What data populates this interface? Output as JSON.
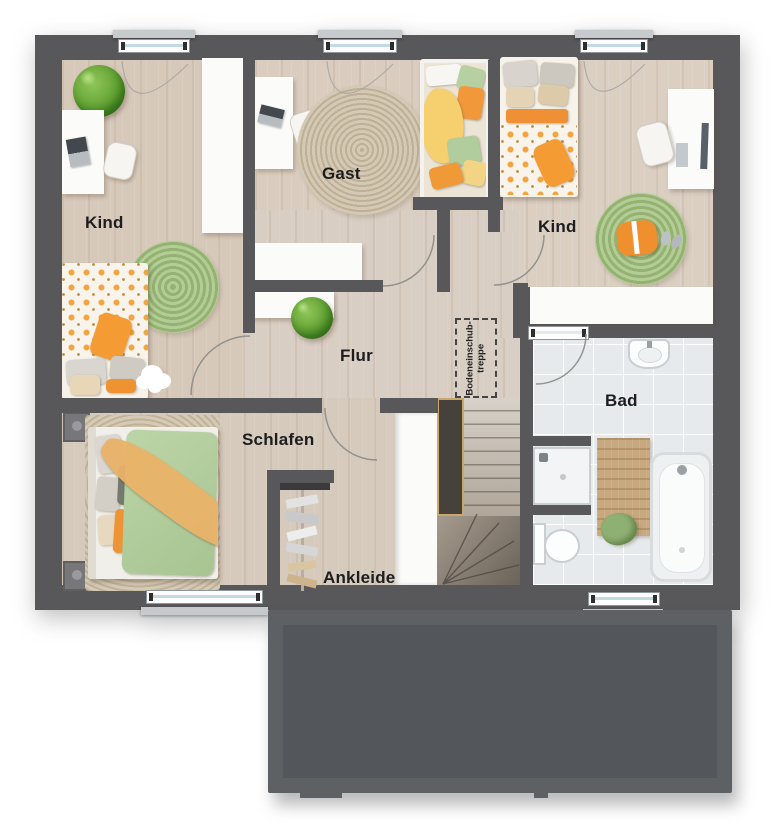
{
  "floorplan": {
    "rooms": [
      {
        "id": "kind-left",
        "label": "Kind"
      },
      {
        "id": "gast",
        "label": "Gast"
      },
      {
        "id": "kind-right",
        "label": "Kind"
      },
      {
        "id": "flur",
        "label": "Flur"
      },
      {
        "id": "schlafen",
        "label": "Schlafen"
      },
      {
        "id": "ankleide",
        "label": "Ankleide"
      },
      {
        "id": "bad",
        "label": "Bad"
      }
    ],
    "loft_ladder_label": {
      "line1": "Bodeneinschub-",
      "line2": "treppe"
    },
    "colors": {
      "wall": "#58585b",
      "wood_floor": "#d8ccbf",
      "bathroom_tile": "#e7eaec",
      "rug_green": "#a9c687",
      "rug_beige": "#ccbfa7",
      "bed_orange": "#f09a37",
      "bed_yellow": "#f5d06f",
      "bed_green": "#b6d0a1",
      "lower_roof": "#53575a"
    }
  }
}
